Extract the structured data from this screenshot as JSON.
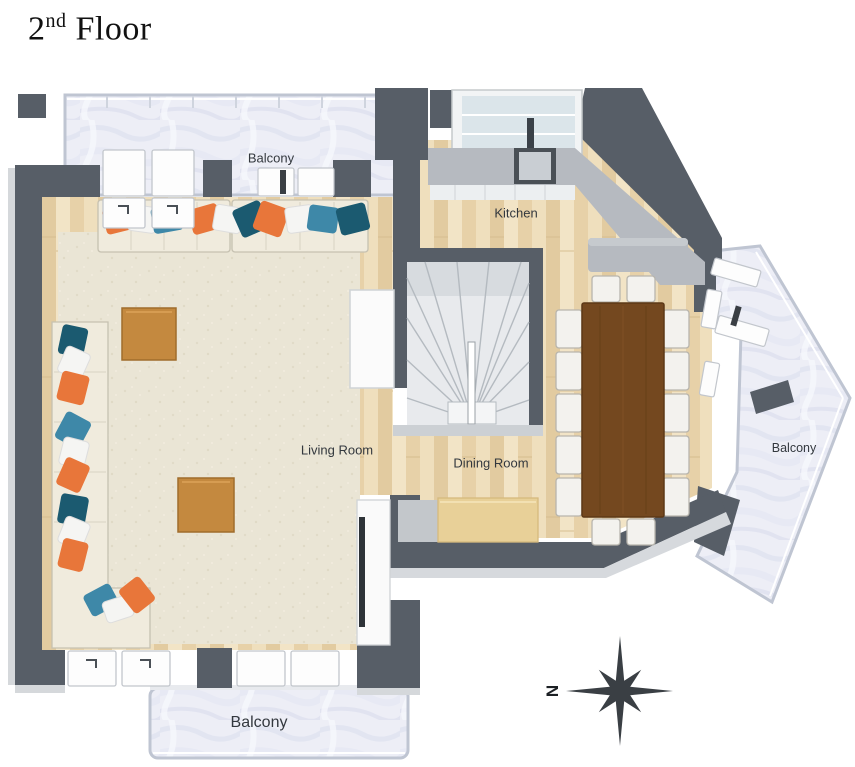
{
  "title": {
    "number": "2",
    "ordinal": "nd",
    "rest": " Floor"
  },
  "labels": {
    "balcony_top": "Balcony",
    "kitchen": "Kitchen",
    "living_room": "Living Room",
    "dining_room": "Dining Room",
    "balcony_right": "Balcony",
    "balcony_bottom": "Balcony"
  },
  "compass": {
    "north_label": "N",
    "north_direction": "left"
  },
  "colors": {
    "wall": "#575e67",
    "wall_edge": "#d5d8db",
    "wood_floor": "#ecd9b3",
    "rug": "#eae5d5",
    "balcony_marble": "#edeef6",
    "sofa": "#f0ebdd",
    "pillow_orange": "#e8763a",
    "pillow_teal": "#3e88a8",
    "pillow_dark_teal": "#1b5a70",
    "pillow_white": "#f5f5f3",
    "coffee_table": "#c4893f",
    "dining_table": "#74481f",
    "kitchen_counter": "#b6bac0",
    "sideboard": "#e8d098",
    "compass": "#3a3f44"
  }
}
